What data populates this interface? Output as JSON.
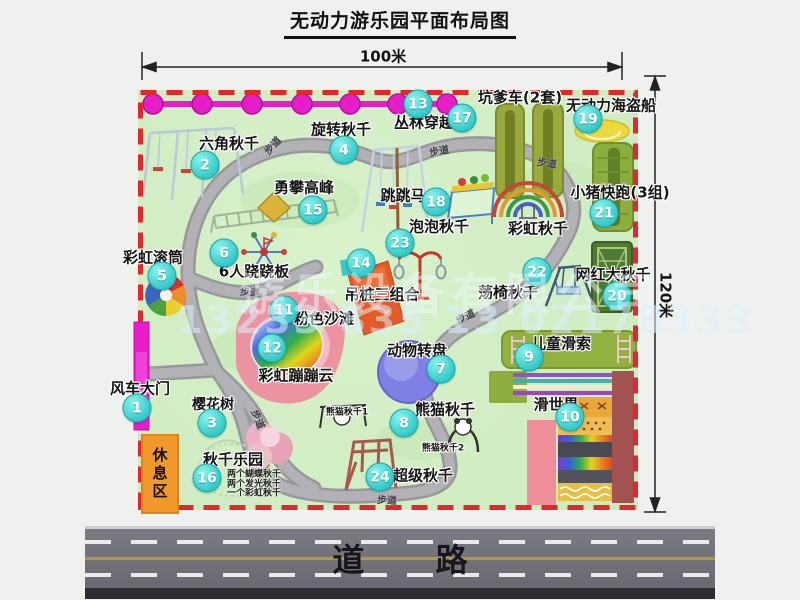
{
  "title": "无动力游乐园平面布局图",
  "dim": {
    "width": "100米",
    "height": "120米"
  },
  "road": {
    "label": "道  路"
  },
  "watermark": {
    "company": "游乐设备有限公司",
    "phone": "13233 835 13 02178333"
  },
  "walkway": "步道",
  "rest_area": "休息区",
  "attractions": [
    {
      "num": "1",
      "name": "风车大门"
    },
    {
      "num": "2",
      "name": "六角秋千"
    },
    {
      "num": "3",
      "name": "樱花树"
    },
    {
      "num": "4",
      "name": "旋转秋千"
    },
    {
      "num": "5",
      "name": "彩虹滚筒"
    },
    {
      "num": "6",
      "name": "6人跷跷板"
    },
    {
      "num": "7",
      "name": "动物转盘"
    },
    {
      "num": "8",
      "name": "熊猫秋千"
    },
    {
      "num": "9",
      "name": "儿童滑索"
    },
    {
      "num": "10",
      "name": "滑世界"
    },
    {
      "num": "11",
      "name": "粉色沙滩"
    },
    {
      "num": "12",
      "name": "彩虹蹦蹦云"
    },
    {
      "num": "13",
      "name": "丛林穿越"
    },
    {
      "num": "14",
      "name": "吊桩三组合"
    },
    {
      "num": "15",
      "name": "勇攀高峰"
    },
    {
      "num": "16",
      "name": "秋千乐园"
    },
    {
      "num": "17",
      "name": "坑爹车(2套)"
    },
    {
      "num": "18",
      "name": "跳跳马"
    },
    {
      "num": "19",
      "name": "无动力海盗船"
    },
    {
      "num": "20",
      "name": "网红大秋千"
    },
    {
      "num": "21",
      "name": "小猪快跑(3组)"
    },
    {
      "num": "22",
      "name": "荡椅秋千"
    },
    {
      "num": "23",
      "name": "泡泡秋千"
    },
    {
      "num": "24",
      "name": "超级秋千"
    }
  ],
  "extra_labels": {
    "rainbow_swing": "彩虹秋千",
    "panda_swing_1": "熊猫秋千1",
    "panda_swing_2": "熊猫秋千2",
    "swing_park_notes": [
      "两个蝴蝶秋千",
      "两个发光秋千",
      "一个彩虹秋千"
    ]
  }
}
